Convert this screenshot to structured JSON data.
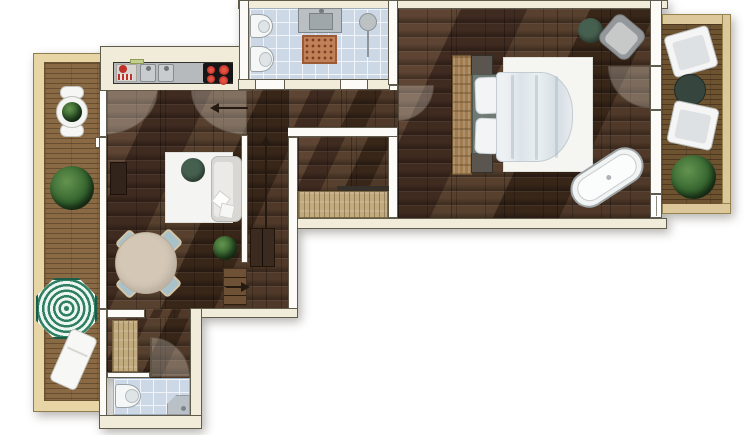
{
  "meta": {
    "type": "floor-plan",
    "view": "top-down 2D rendered architectural plan",
    "canvas": {
      "width": 754,
      "height": 435
    },
    "visible_text": "none"
  },
  "palette": {
    "wall_outer": "#f1ecd9",
    "wall_inner": "#fcfbf7",
    "wall_line": "#5f5c4e",
    "floor": "#4c3427",
    "deck_left": "#8a6a44",
    "deck_right": "#6e5331",
    "frame_left": "#e8d5a5",
    "frame_right": "#dcc89a",
    "tile": "#ccd8e5",
    "green": "#46604f",
    "plant": "#35652f",
    "rug": "#c08058",
    "parasol": "#2e7f63",
    "arrow": "#241a12",
    "white_fixture": "#f5f6f6",
    "counter": "#b6babd",
    "cooktop": "#161616",
    "burner": "#c2322a",
    "table_beige": "#d4c7b6",
    "chair_blue": "#a9c2ca",
    "wood_light": "#c2aa7f"
  },
  "rooms": {
    "terrace_left": {
      "label": "Left terrace (wood deck)",
      "furniture": [
        "bistro table with plant",
        "2 bistro chairs",
        "large potted plant",
        "striped parasol",
        "sun lounger"
      ]
    },
    "kitchen": {
      "label": "Kitchenette niche",
      "furniture": [
        "counter",
        "dish rack",
        "double sink",
        "4-burner cooktop"
      ]
    },
    "living_room": {
      "label": "Living / dining room",
      "furniture": [
        "area rug",
        "sofa with cushions",
        "round coffee table",
        "wall sideboard",
        "round dining table",
        "4 dining chairs",
        "potted plant",
        "corridor cabinet",
        "entry steps"
      ]
    },
    "bathroom_main": {
      "label": "Main bathroom",
      "furniture": [
        "toilet",
        "bidet",
        "vanity with sink",
        "patterned bath rug",
        "wall towel dryer"
      ]
    },
    "hallway": {
      "label": "Hallway",
      "furniture": []
    },
    "entrance_hall": {
      "label": "Entrance hall",
      "furniture": [
        "wardrobe with coat rod"
      ]
    },
    "bedroom": {
      "label": "Bedroom",
      "furniture": [
        "double bed with duvet",
        "2 pillows",
        "rustic headboard board",
        "2 nightstands",
        "white area rug",
        "green pouf",
        "armchair",
        "freestanding bathtub"
      ]
    },
    "balcony_right": {
      "label": "Right balcony (wood deck)",
      "furniture": [
        "2 lounge armchairs",
        "round side table",
        "potted plant"
      ]
    },
    "hall_lower": {
      "label": "Lower hall",
      "furniture": [
        "wardrobe"
      ]
    },
    "bathroom_shower": {
      "label": "Shower bathroom",
      "furniture": [
        "toilet",
        "corner shower"
      ]
    }
  },
  "annotations": {
    "arrows": [
      {
        "id": "kitchen-pass-arrow",
        "direction": "left",
        "location": "below kitchen counter"
      },
      {
        "id": "stair-up-arrow",
        "direction": "up",
        "location": "central corridor"
      },
      {
        "id": "entry-step-arrow",
        "direction": "right",
        "location": "steps at dining corner"
      }
    ],
    "door_swings": 6
  }
}
